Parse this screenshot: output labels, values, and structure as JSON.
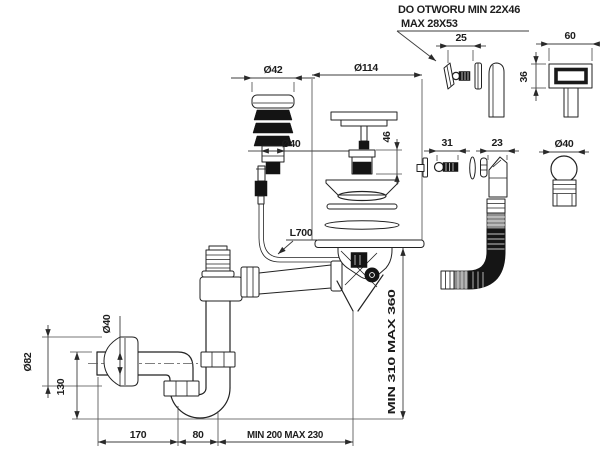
{
  "drawing": {
    "note": {
      "line1": "DO OTWORU MIN 22X46",
      "line2": "MAX 28X53"
    },
    "dims": {
      "plug_cap": "Ø42",
      "plug_body": "Ø40",
      "strainer": "Ø114",
      "strainer_depth": "46",
      "mount_screw": "25",
      "button_width": "60",
      "button_height": "36",
      "overflow_screw": "31",
      "overflow_elbow": "23",
      "overflow_body": "Ø40",
      "cable": "L700",
      "outlet_pipe": "Ø40",
      "wall_rosette": "Ø82",
      "trap_height": "130",
      "outlet_length": "170",
      "trap_width": "80",
      "drain_offset": "MIN 200 MAX 230",
      "drain_height": "MIN 310 MAX 360"
    },
    "colors": {
      "line": "#222222",
      "dimension": "#3c3c3c",
      "dark_fill": "#141414",
      "hose_gray": "#8f8f8f",
      "background": "#ffffff"
    }
  }
}
